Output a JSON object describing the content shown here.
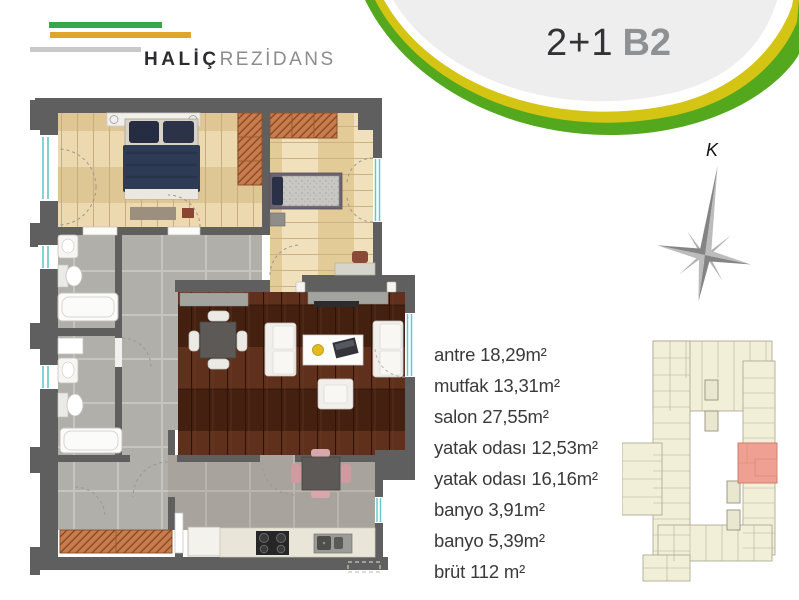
{
  "brand": {
    "title_bold": "HALİÇ",
    "title_light": "REZİDANS",
    "bar_green": "#35a84c",
    "bar_orange": "#e0a42c",
    "bar_gray": "#c9c9c9"
  },
  "header": {
    "unit_layout": "2+1",
    "unit_block": "B2",
    "band_yellow": "#d4c414",
    "band_green": "#54a81d",
    "panel_gray": "#eeeeef"
  },
  "compass": {
    "north_label": "K",
    "icon": "compass-rose-icon"
  },
  "rooms": [
    {
      "name": "antre",
      "area": "18,29m²"
    },
    {
      "name": "mutfak",
      "area": "13,31m²"
    },
    {
      "name": "salon",
      "area": "27,55m²"
    },
    {
      "name": "yatak odası",
      "area": "12,53m²"
    },
    {
      "name": "yatak odası",
      "area": "16,16m²"
    },
    {
      "name": "banyo",
      "area": "3,91m²"
    },
    {
      "name": "banyo",
      "area": "5,39m²"
    },
    {
      "name": "brüt",
      "area": "112 m²"
    }
  ],
  "floor_plan": {
    "wall_color": "#5f5f5f",
    "light_wood": "#e6d0a4",
    "dark_wood": "#512817",
    "tile_gray": "#b1afaa",
    "wardrobe_orange": "#c87c4c",
    "window_teal": "#63c6ca"
  },
  "key_plan": {
    "building_fill": "#f2efd8",
    "highlight_unit": "#efa093"
  }
}
